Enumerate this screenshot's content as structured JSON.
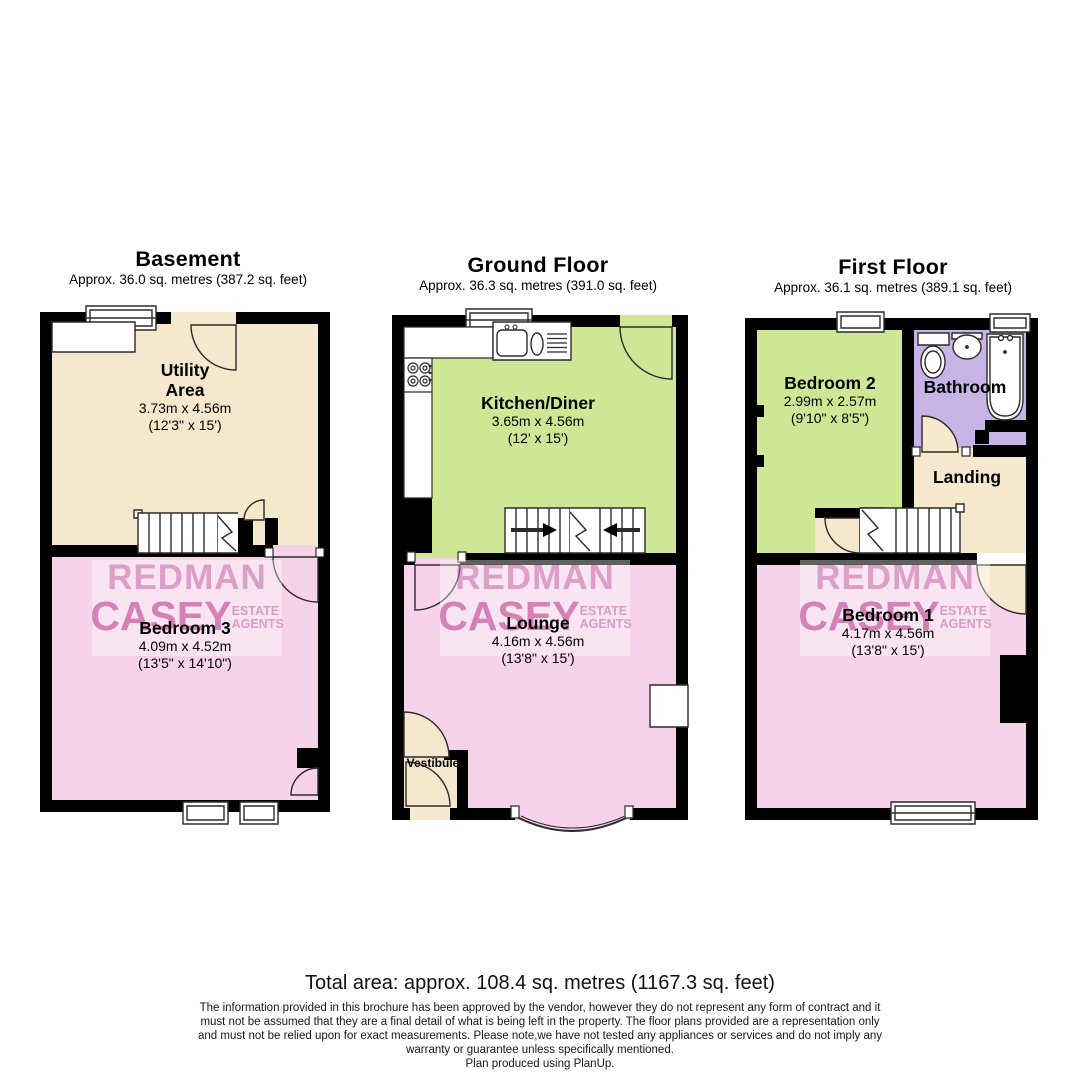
{
  "floors": {
    "basement": {
      "title": "Basement",
      "area_text": "Approx. 36.0 sq. metres (387.2 sq. feet)",
      "rooms": {
        "utility": {
          "name": "Utility Area",
          "metric": "3.73m x 4.56m",
          "imperial": "(12'3\" x 15')"
        },
        "bedroom3": {
          "name": "Bedroom 3",
          "metric": "4.09m x 4.52m",
          "imperial": "(13'5\" x 14'10\")"
        }
      }
    },
    "ground": {
      "title": "Ground Floor",
      "area_text": "Approx. 36.3 sq. metres (391.0 sq. feet)",
      "rooms": {
        "kitchen": {
          "name": "Kitchen/Diner",
          "metric": "3.65m x 4.56m",
          "imperial": "(12' x 15')"
        },
        "lounge": {
          "name": "Lounge",
          "metric": "4.16m x 4.56m",
          "imperial": "(13'8\" x 15')"
        },
        "vestibule": {
          "name": "Vestibule"
        }
      }
    },
    "first": {
      "title": "First Floor",
      "area_text": "Approx. 36.1 sq. metres (389.1 sq. feet)",
      "rooms": {
        "bedroom2": {
          "name": "Bedroom 2",
          "metric": "2.99m x 2.57m",
          "imperial": "(9'10\" x 8'5\")"
        },
        "bathroom": {
          "name": "Bathroom"
        },
        "landing": {
          "name": "Landing"
        },
        "bedroom1": {
          "name": "Bedroom 1",
          "metric": "4.17m x 4.56m",
          "imperial": "(13'8\" x 15')"
        }
      }
    }
  },
  "watermark": {
    "line1": "REDMAN",
    "line2": "CASEY",
    "sub1": "ESTATE",
    "sub2": "AGENTS"
  },
  "footer": {
    "total_area": "Total area: approx. 108.4 sq. metres (1167.3 sq. feet)",
    "disclaimer_lines": [
      "The information provided in this brochure has been approved by the vendor, however they do not represent any form of contract and it",
      "must not be assumed that they are a final detail of what is being left in the property. The floor plans provided are a representation only",
      "and must not be relied upon for exact measurements. Please note,we have not tested any appliances or services and do not imply any",
      "warranty or guarantee unless specifically mentioned."
    ],
    "credit": "Plan produced using PlanUp."
  },
  "colors": {
    "cream": "#F6E8CC",
    "pink": "#F6D3EA",
    "green": "#CEE795",
    "purple": "#C7B3E6",
    "wall": "#000000",
    "watermark_pink": "#DA8FC0"
  }
}
